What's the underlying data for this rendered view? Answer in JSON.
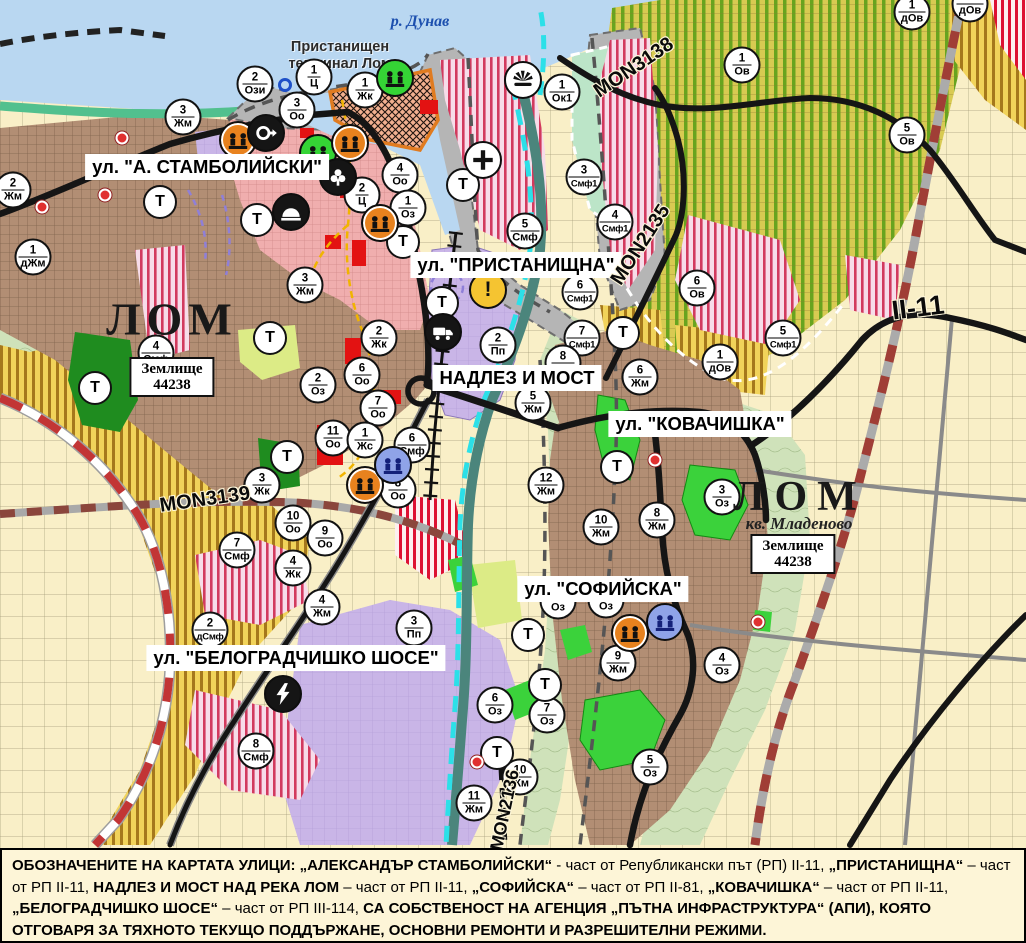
{
  "map": {
    "river_label": {
      "text": "р. Дунав",
      "x": 420,
      "y": 22
    },
    "terminal_label": {
      "text": "Пристанищен терминал Лом",
      "x": 340,
      "y": 56
    },
    "city_labels": [
      {
        "text": "ЛОМ",
        "x": 172,
        "y": 319,
        "size": 46,
        "ls": 6
      },
      {
        "text": "ЛОМ",
        "x": 800,
        "y": 497,
        "size": 42,
        "ls": 10
      }
    ],
    "district_label": {
      "text": "кв. Младеново",
      "x": 799,
      "y": 524
    },
    "land_boxes": [
      {
        "line1": "Землище",
        "line2": "44238",
        "x": 172,
        "y": 377
      },
      {
        "line1": "Землище",
        "line2": "44238",
        "x": 793,
        "y": 554
      }
    ],
    "street_labels": [
      {
        "text": "ул. \"А. СТАМБОЛИЙСКИ\"",
        "x": 207,
        "y": 167
      },
      {
        "text": "ул. \"ПРИСТАНИЩНА\"",
        "x": 516,
        "y": 265
      },
      {
        "text": "НАДЛЕЗ И МОСТ",
        "x": 517,
        "y": 378
      },
      {
        "text": "ул. \"КОВАЧИШКА\"",
        "x": 700,
        "y": 424
      },
      {
        "text": "ул. \"СОФИЙСКА\"",
        "x": 603,
        "y": 589
      },
      {
        "text": "ул. \"БЕЛОГРАДЧИШКО ШОСЕ\"",
        "x": 296,
        "y": 658
      }
    ],
    "road_labels": [
      {
        "text": "MON3139",
        "x": 205,
        "y": 500,
        "rot": -8,
        "size": 20
      },
      {
        "text": "MON3138",
        "x": 634,
        "y": 68,
        "rot": -34,
        "size": 20
      },
      {
        "text": "MON2135",
        "x": 641,
        "y": 245,
        "rot": -57,
        "size": 20
      },
      {
        "text": "II-11",
        "x": 918,
        "y": 308,
        "rot": -7,
        "size": 27
      },
      {
        "text": "MON2136",
        "x": 505,
        "y": 810,
        "rot": -78,
        "size": 18
      }
    ],
    "t_label": "Т",
    "warning_char": "!",
    "zone_markers": [
      {
        "n": "2",
        "c": "Ози",
        "x": 255,
        "y": 84
      },
      {
        "n": "1",
        "c": "Ц",
        "x": 314,
        "y": 77
      },
      {
        "n": "1",
        "c": "Жк",
        "x": 365,
        "y": 90
      },
      {
        "n": "3",
        "c": "Оо",
        "x": 297,
        "y": 110
      },
      {
        "n": "3",
        "c": "Жм",
        "x": 183,
        "y": 117
      },
      {
        "n": "2",
        "c": "Жм",
        "x": 13,
        "y": 190
      },
      {
        "n": "1",
        "c": "дЖм",
        "x": 33,
        "y": 257
      },
      {
        "n": "4",
        "c": "Оо",
        "x": 400,
        "y": 175
      },
      {
        "n": "2",
        "c": "Ц",
        "x": 362,
        "y": 195
      },
      {
        "n": "1",
        "c": "Оз",
        "x": 408,
        "y": 208
      },
      {
        "n": "1",
        "c": "Ок1",
        "x": 562,
        "y": 92
      },
      {
        "n": "5",
        "c": "Смф",
        "x": 525,
        "y": 231
      },
      {
        "n": "3",
        "c": "Смф1",
        "x": 584,
        "y": 177
      },
      {
        "n": "4",
        "c": "Смф1",
        "x": 615,
        "y": 222
      },
      {
        "n": "1",
        "c": "Ов",
        "x": 742,
        "y": 65
      },
      {
        "n": "5",
        "c": "Ов",
        "x": 907,
        "y": 135
      },
      {
        "n": "1",
        "c": "дОв",
        "x": 912,
        "y": 12
      },
      {
        "n": "",
        "c": "дОв",
        "x": 970,
        "y": 4
      },
      {
        "n": "6",
        "c": "Ов",
        "x": 697,
        "y": 288
      },
      {
        "n": "1",
        "c": "дОв",
        "x": 720,
        "y": 362
      },
      {
        "n": "5",
        "c": "Смф1",
        "x": 783,
        "y": 338
      },
      {
        "n": "6",
        "c": "Смф1",
        "x": 580,
        "y": 292
      },
      {
        "n": "7",
        "c": "Смф1",
        "x": 582,
        "y": 338
      },
      {
        "n": "2",
        "c": "Пп",
        "x": 498,
        "y": 345
      },
      {
        "n": "8",
        "c": "Жм",
        "x": 563,
        "y": 363
      },
      {
        "n": "5",
        "c": "Жм",
        "x": 533,
        "y": 403
      },
      {
        "n": "6",
        "c": "Жм",
        "x": 640,
        "y": 377
      },
      {
        "n": "12",
        "c": "Жм",
        "x": 546,
        "y": 485
      },
      {
        "n": "4",
        "c": "Смф",
        "x": 156,
        "y": 353
      },
      {
        "n": "2",
        "c": "Оз",
        "x": 318,
        "y": 385
      },
      {
        "n": "6",
        "c": "Оо",
        "x": 362,
        "y": 375
      },
      {
        "n": "7",
        "c": "Оо",
        "x": 378,
        "y": 408
      },
      {
        "n": "11",
        "c": "Оо",
        "x": 333,
        "y": 438
      },
      {
        "n": "1",
        "c": "Жс",
        "x": 365,
        "y": 440
      },
      {
        "n": "2",
        "c": "Жк",
        "x": 379,
        "y": 338
      },
      {
        "n": "3",
        "c": "Жк",
        "x": 262,
        "y": 485
      },
      {
        "n": "8",
        "c": "Оо",
        "x": 398,
        "y": 490
      },
      {
        "n": "6",
        "c": "Смф",
        "x": 412,
        "y": 445
      },
      {
        "n": "3",
        "c": "Жм",
        "x": 305,
        "y": 285
      },
      {
        "n": "10",
        "c": "Оо",
        "x": 293,
        "y": 523
      },
      {
        "n": "9",
        "c": "Оо",
        "x": 325,
        "y": 538
      },
      {
        "n": "7",
        "c": "Смф",
        "x": 237,
        "y": 550
      },
      {
        "n": "2",
        "c": "дСмф",
        "x": 210,
        "y": 630
      },
      {
        "n": "4",
        "c": "Жк",
        "x": 293,
        "y": 568
      },
      {
        "n": "4",
        "c": "Жм",
        "x": 322,
        "y": 607
      },
      {
        "n": "3",
        "c": "Пп",
        "x": 414,
        "y": 628
      },
      {
        "n": "8",
        "c": "Смф",
        "x": 256,
        "y": 751
      },
      {
        "n": "10",
        "c": "Жм",
        "x": 601,
        "y": 527
      },
      {
        "n": "8",
        "c": "Жм",
        "x": 657,
        "y": 520
      },
      {
        "n": "3",
        "c": "Оз",
        "x": 722,
        "y": 497
      },
      {
        "n": "9",
        "c": "Жм",
        "x": 618,
        "y": 663
      },
      {
        "n": "4",
        "c": "Оз",
        "x": 722,
        "y": 665
      },
      {
        "n": "6",
        "c": "Оз",
        "x": 495,
        "y": 705
      },
      {
        "n": "7",
        "c": "Оз",
        "x": 547,
        "y": 715
      },
      {
        "n": "5",
        "c": "Оз",
        "x": 650,
        "y": 767
      },
      {
        "n": "10",
        "c": "Жм",
        "x": 520,
        "y": 777
      },
      {
        "n": "11",
        "c": "Жм",
        "x": 474,
        "y": 803
      },
      {
        "n": "",
        "c": "Оз",
        "x": 558,
        "y": 601
      },
      {
        "n": "",
        "c": "Оз",
        "x": 606,
        "y": 600
      }
    ],
    "t_markers": [
      {
        "x": 160,
        "y": 202
      },
      {
        "x": 257,
        "y": 220
      },
      {
        "x": 403,
        "y": 242
      },
      {
        "x": 463,
        "y": 185
      },
      {
        "x": 442,
        "y": 303
      },
      {
        "x": 95,
        "y": 388
      },
      {
        "x": 270,
        "y": 338
      },
      {
        "x": 287,
        "y": 457
      },
      {
        "x": 623,
        "y": 333
      },
      {
        "x": 617,
        "y": 467
      },
      {
        "x": 528,
        "y": 635
      },
      {
        "x": 545,
        "y": 685
      },
      {
        "x": 497,
        "y": 753
      }
    ],
    "icon_markers": [
      {
        "kind": "monument",
        "variant": "green",
        "x": 395,
        "y": 78
      },
      {
        "kind": "monument",
        "variant": "green",
        "x": 318,
        "y": 153
      },
      {
        "kind": "monument",
        "variant": "orange",
        "x": 238,
        "y": 140
      },
      {
        "kind": "monument",
        "variant": "orange",
        "x": 350,
        "y": 143
      },
      {
        "kind": "monument",
        "variant": "orange",
        "x": 380,
        "y": 223
      },
      {
        "kind": "monument",
        "variant": "orange",
        "x": 365,
        "y": 485
      },
      {
        "kind": "monument",
        "variant": "orange",
        "x": 630,
        "y": 633
      },
      {
        "kind": "monument",
        "variant": "blue",
        "x": 393,
        "y": 465
      },
      {
        "kind": "monument",
        "variant": "blue",
        "x": 665,
        "y": 622
      },
      {
        "kind": "spring",
        "x": 266,
        "y": 133
      },
      {
        "kind": "statue",
        "x": 338,
        "y": 177
      },
      {
        "kind": "tumulus",
        "x": 291,
        "y": 212
      },
      {
        "kind": "truck",
        "x": 443,
        "y": 332
      },
      {
        "kind": "lightning",
        "x": 283,
        "y": 694
      },
      {
        "kind": "church",
        "x": 483,
        "y": 160
      },
      {
        "kind": "portfan",
        "x": 523,
        "y": 80
      },
      {
        "kind": "warning",
        "x": 488,
        "y": 290
      }
    ],
    "red_dots": [
      {
        "x": 122,
        "y": 138
      },
      {
        "x": 105,
        "y": 195
      },
      {
        "x": 42,
        "y": 207
      },
      {
        "x": 655,
        "y": 460
      },
      {
        "x": 477,
        "y": 762
      },
      {
        "x": 758,
        "y": 622
      }
    ],
    "blue_ring": {
      "x": 285,
      "y": 85
    }
  },
  "caption": {
    "segments": [
      {
        "text": "ОБОЗНАЧЕНИТЕ НА КАРТАТА УЛИЦИ: „АЛЕКСАНДЪР СТАМБОЛИЙСКИ“",
        "bold": true
      },
      {
        "text": " - част от Републикански път (РП) II-11, ",
        "bold": false
      },
      {
        "text": "„ПРИСТАНИЩНА“",
        "bold": true
      },
      {
        "text": " – част от РП II-11, ",
        "bold": false
      },
      {
        "text": "НАДЛЕЗ И МОСТ НАД РЕКА ЛОМ",
        "bold": true
      },
      {
        "text": " – част от РП II-11, ",
        "bold": false
      },
      {
        "text": "„СОФИЙСКА“",
        "bold": true
      },
      {
        "text": " – част от РП II-81, ",
        "bold": false
      },
      {
        "text": "„КОВАЧИШКА“",
        "bold": true
      },
      {
        "text": " – част от РП II-11, ",
        "bold": false
      },
      {
        "text": "„БЕЛОГРАДЧИШКО ШОСЕ“",
        "bold": true
      },
      {
        "text": " – част от РП III-114, ",
        "bold": false
      },
      {
        "text": "СА СОБСТВЕНОСТ НА АГЕНЦИЯ „ПЪТНА ИНФРАСТРУКТУРА“ (АПИ), КОЯТО ОТГОВАРЯ ЗА ТЯХНОТО ТЕКУЩО ПОДДЪРЖАНЕ, ОСНОВНИ РЕМОНТИ И РАЗРЕШИТЕЛНИ РЕЖИМИ.",
        "bold": true
      }
    ]
  },
  "colors": {
    "water": "#b9d7f1",
    "urban_brown": "#b28e74",
    "lavender": "#c9b5e7",
    "field_yellow": "#f1d35a",
    "vineyard_green": "#d8ca52",
    "stripe_crimson": "#d23a5e",
    "road_black": "#151515",
    "boundary_red": "#c23535",
    "stream_cyan": "#2ce0e8",
    "park_green": "#3bd23b",
    "forest_green": "#1f8c1f",
    "port_gray": "#b5b5b5",
    "caption_bg": "#fdf5d7"
  }
}
